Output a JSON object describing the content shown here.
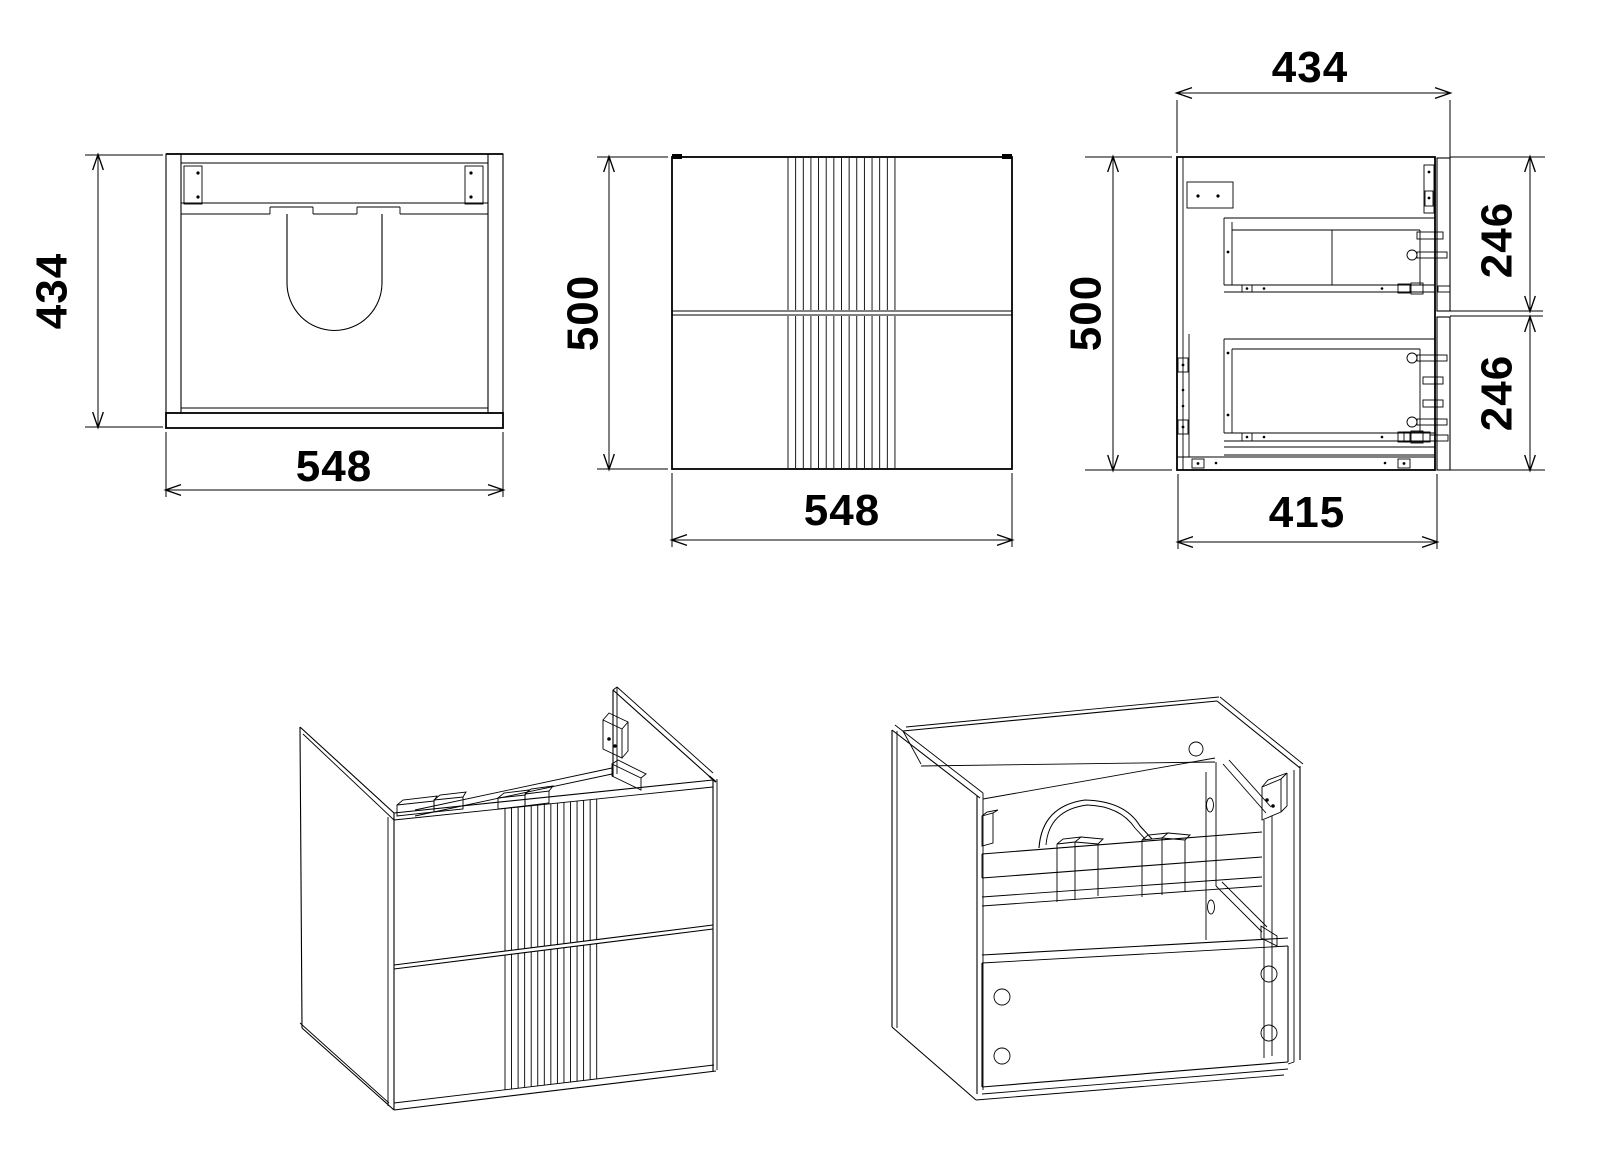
{
  "colors": {
    "ink": "#000000",
    "paper": "#ffffff"
  },
  "views": {
    "plan": {
      "label_depth": "434",
      "label_width": "548"
    },
    "front": {
      "label_height": "500",
      "label_width": "548"
    },
    "side": {
      "label_depth_overall": "434",
      "label_height": "500",
      "label_drawer_upper": "246",
      "label_drawer_lower": "246",
      "label_depth_body": "415"
    }
  }
}
